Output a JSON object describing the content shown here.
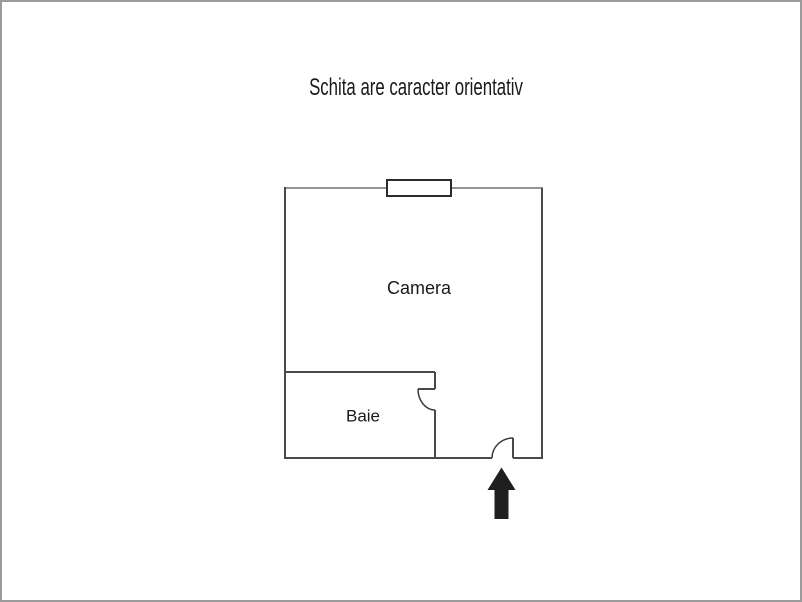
{
  "title": {
    "text": "Schita are caracter orientativ"
  },
  "floor_plan": {
    "room_labels": {
      "main_room": "Camera",
      "bathroom": "Baie"
    },
    "symbols": [
      "window-symbol",
      "door-swing-arc",
      "entrance-arrow"
    ]
  },
  "colors": {
    "page_border": "#9b9b9b",
    "wall_dark": "#4a4a4a",
    "wall_light": "#949494",
    "window_border": "#2b2b2b",
    "door_arc": "#3a3a3a",
    "arrow_fill": "#1f1f1f",
    "text": "#1a1a1a"
  }
}
